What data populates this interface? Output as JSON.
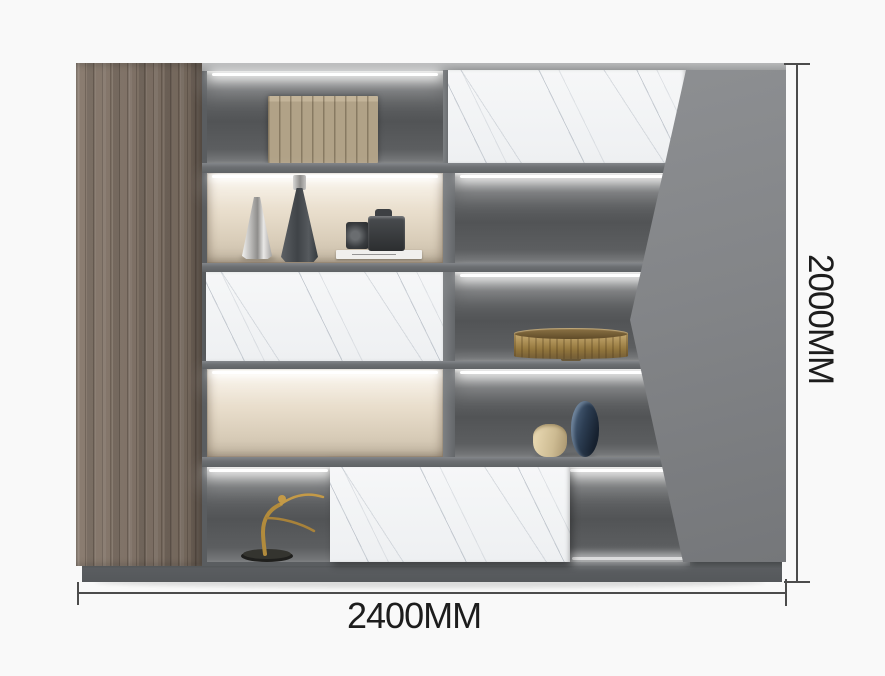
{
  "image": {
    "type": "furniture-product-photo",
    "subject": "gray wall cabinet bookcase with LED shelves and marble drawer fronts",
    "background_color": "#f9f9f9"
  },
  "dimensions": {
    "width": {
      "label": "2400MM"
    },
    "height": {
      "label": "2000MM"
    },
    "line_color": "#4c4c4c",
    "label_color": "#1d1d1d"
  },
  "cabinet": {
    "palette": {
      "wood_door": "#7b6e63",
      "frame_gray": "#6b6e71",
      "angular_panel": "#828487",
      "marble_front": "#f3f4f6",
      "lit_shelf_interior": "#e8ddcb",
      "dark_shelf_interior": "#55575a",
      "plinth": "#55585b",
      "led_light": "#ffffff"
    },
    "decor_items": [
      {
        "name": "tan-books-row",
        "color": "#b1a287"
      },
      {
        "name": "silver-cone-vase",
        "color": "#c9c9c7"
      },
      {
        "name": "dark-cone-vase",
        "color": "#45494d"
      },
      {
        "name": "dslr-camera-on-book",
        "color": "#2e3032"
      },
      {
        "name": "bronze-fluted-bowl",
        "color": "#a98a52"
      },
      {
        "name": "beige-round-vase",
        "color": "#d8c69e"
      },
      {
        "name": "navy-oval-vase",
        "color": "#2c3d52"
      },
      {
        "name": "gold-dancer-figurine",
        "color": "#b28b3c"
      }
    ]
  }
}
